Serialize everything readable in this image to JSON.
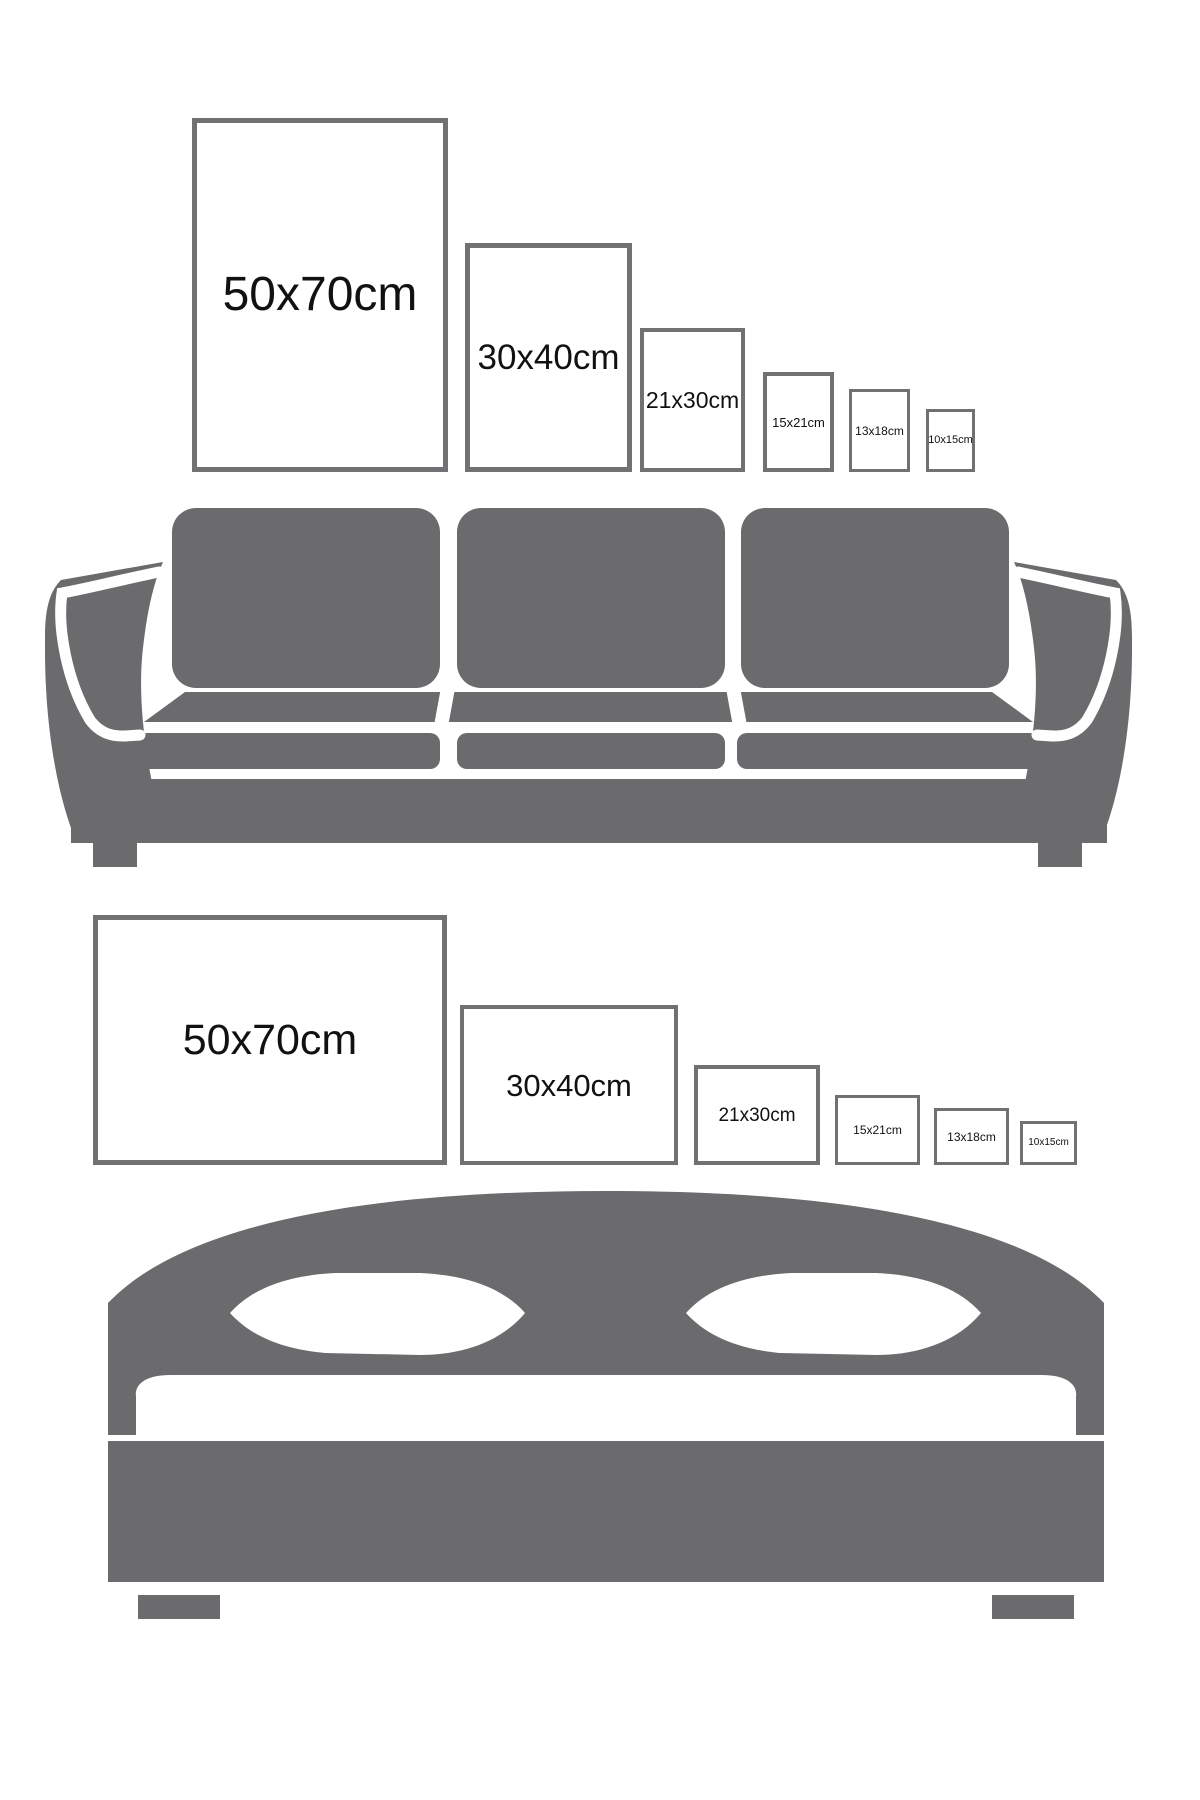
{
  "colors": {
    "background": "#ffffff",
    "furniture": "#6b6b6d",
    "frame_border": "#717173",
    "label": "#111111"
  },
  "top_section": {
    "furniture": "sofa",
    "orientation": "portrait",
    "frames": [
      {
        "label": "50x70cm"
      },
      {
        "label": "30x40cm"
      },
      {
        "label": "21x30cm"
      },
      {
        "label": "15x21cm"
      },
      {
        "label": "13x18cm"
      },
      {
        "label": "10x15cm"
      }
    ]
  },
  "bottom_section": {
    "furniture": "bed",
    "orientation": "landscape",
    "frames": [
      {
        "label": "50x70cm"
      },
      {
        "label": "30x40cm"
      },
      {
        "label": "21x30cm"
      },
      {
        "label": "15x21cm"
      },
      {
        "label": "13x18cm"
      },
      {
        "label": "10x15cm"
      }
    ]
  }
}
